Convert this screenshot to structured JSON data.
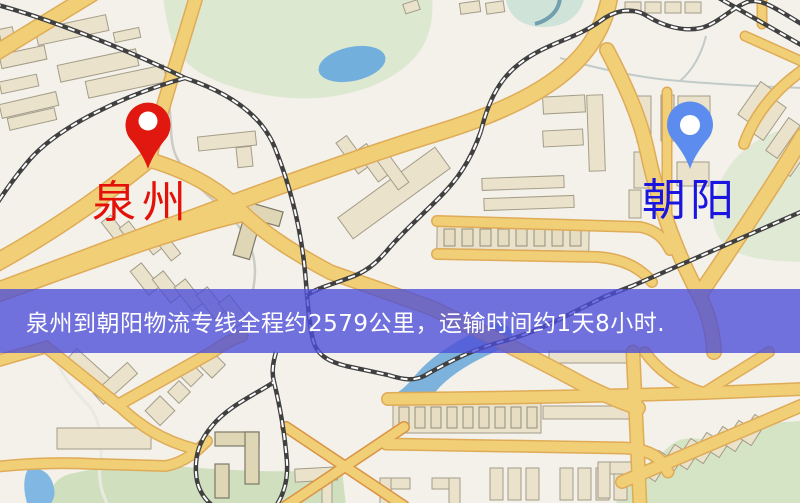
{
  "banner": {
    "text": "泉州到朝阳物流专线全程约2579公里，运输时间约1天8小时.",
    "background": "rgba(75,77,216,0.78)",
    "text_color": "#ffffff"
  },
  "markers": {
    "origin": {
      "name": "泉州",
      "pin_color": "#e9160c",
      "label_color": "#e41108"
    },
    "destination": {
      "name": "朝阳",
      "pin_color": "#5a8cf2",
      "label_color": "#1b15e0"
    }
  },
  "map_palette": {
    "background": "#f3f1ea",
    "road_fill": "#f2cf72",
    "road_border": "#e2ab52",
    "building": "#eae2ca",
    "green_area": "#dde8cf",
    "water": "#6fb0e0",
    "railway": "#404040"
  }
}
